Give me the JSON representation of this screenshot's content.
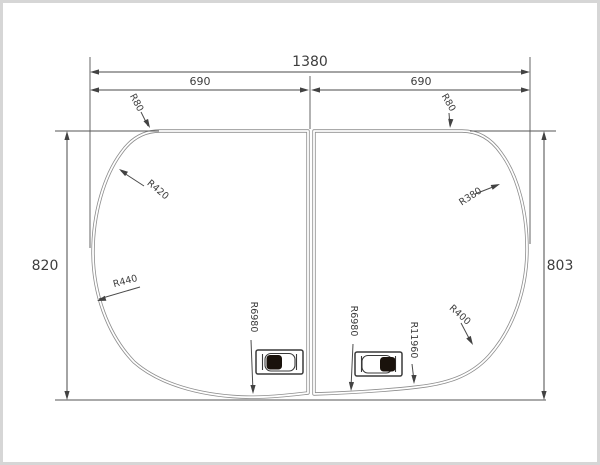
{
  "drawing": {
    "colors": {
      "dimension_line": "#4a4a4a",
      "panel_outline": "#8d8d8d",
      "text": "#3d3d3d",
      "handle_dark": "#1a120c",
      "frame_border": "#d6d6d6",
      "background": "#ffffff"
    },
    "dimensions": {
      "overall_width": "1380",
      "left_panel_width": "690",
      "right_panel_width": "690",
      "left_height": "820",
      "right_height": "803"
    },
    "radii": {
      "top_left_corner": "R80",
      "top_right_corner": "R80",
      "left_upper": "R420",
      "left_lower": "R440",
      "right_upper": "R380",
      "right_lower": "R400",
      "bottom_left": "R6980",
      "bottom_center": "R6980",
      "bottom_right": "R11960"
    }
  }
}
